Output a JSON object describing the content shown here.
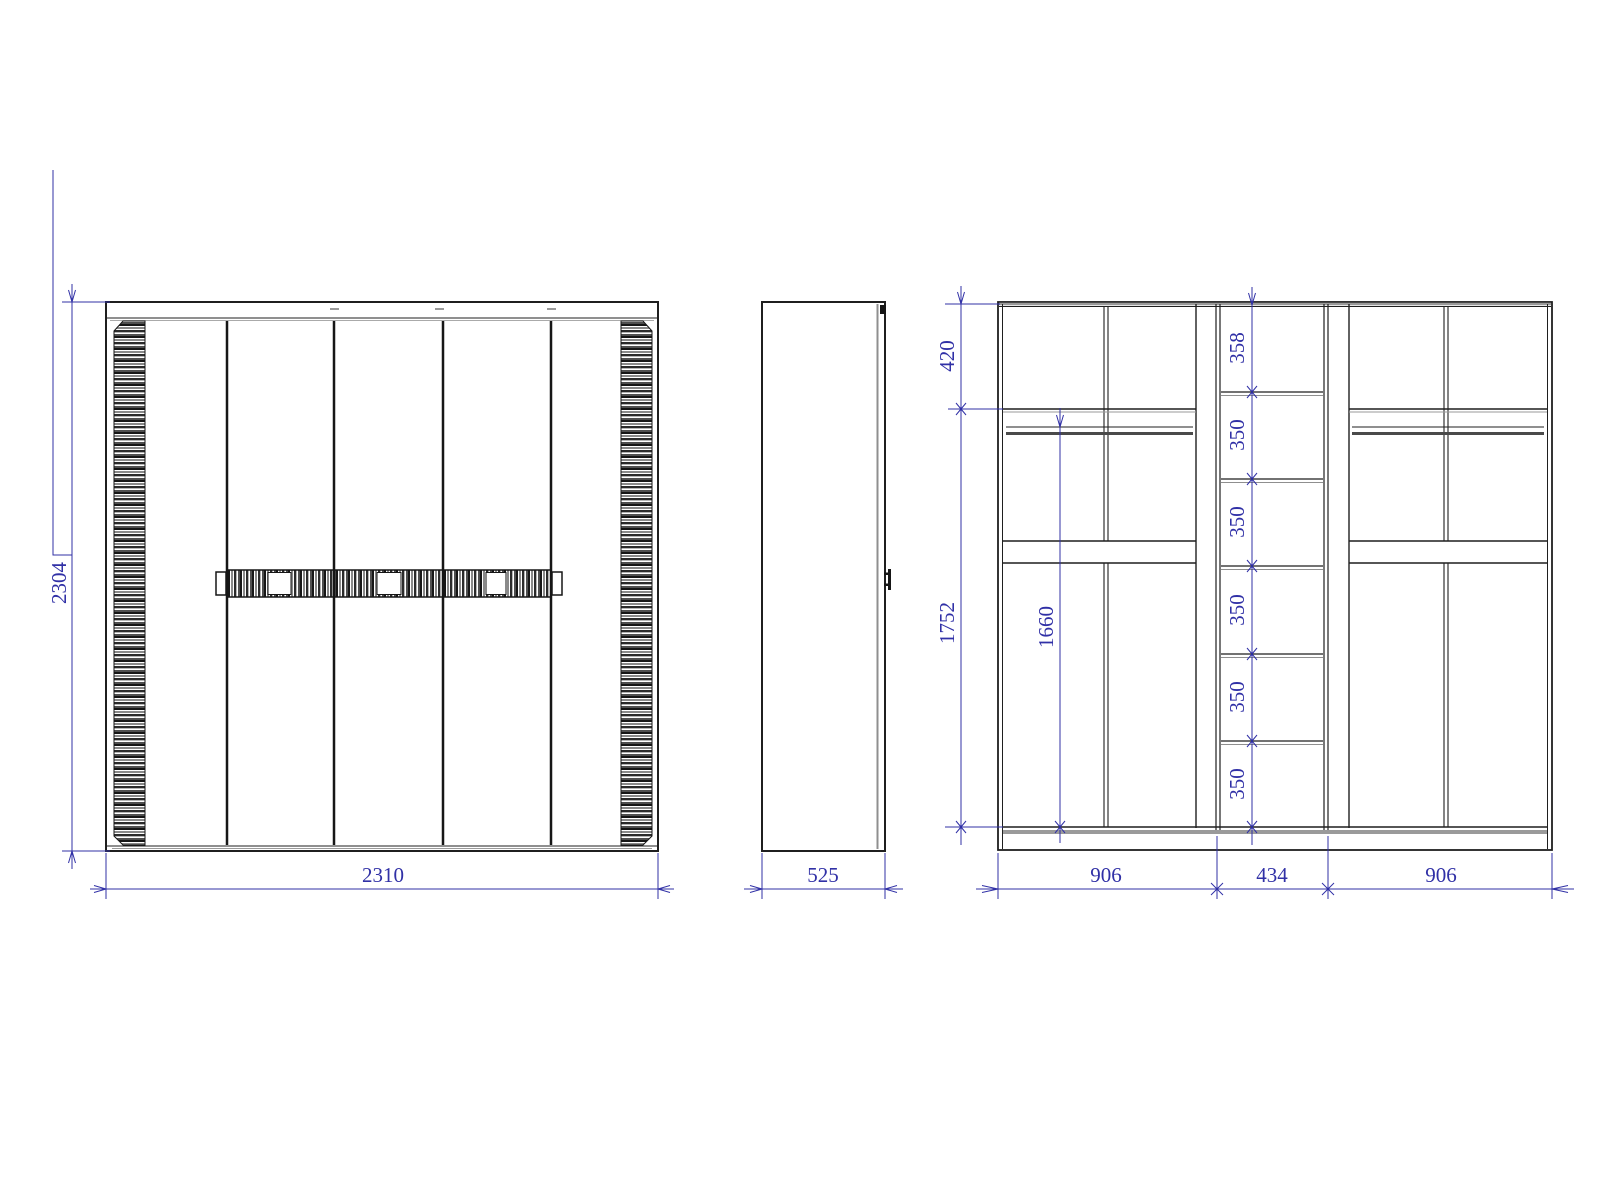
{
  "title": "Wardrobe technical drawing - front, side and internal section views",
  "colors": {
    "line": "#1f1f1f",
    "grey": "#8f8f8f",
    "dim": "#3030a6"
  },
  "views": {
    "front": {
      "height_label": "2304",
      "width_label": "2310"
    },
    "side": {
      "depth_label": "525"
    },
    "internal": {
      "top_section_label": "420",
      "interior_height_label": "1752",
      "hanging_height_label": "1660",
      "middle_shelf_labels": [
        "358",
        "350",
        "350",
        "350",
        "350",
        "350"
      ],
      "bottom_width_labels": [
        "906",
        "434",
        "906"
      ]
    }
  }
}
